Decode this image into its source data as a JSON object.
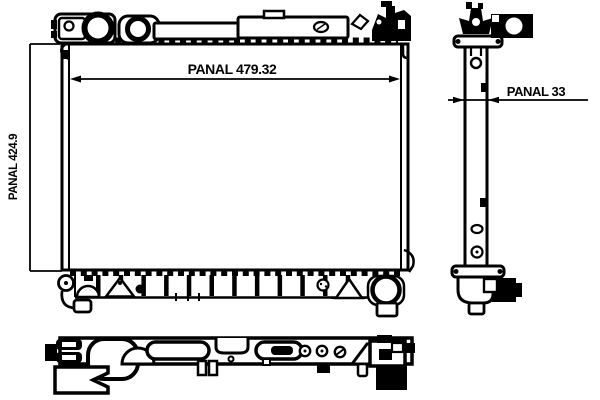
{
  "drawing": {
    "type": "radiator-technical-drawing",
    "dimensions": {
      "width": {
        "label": "PANAL 479.32",
        "value": 479.32
      },
      "height": {
        "label": "PANAL 424.9",
        "value": 424.9
      },
      "depth": {
        "label": "PANAL 33",
        "value": 33
      }
    },
    "colors": {
      "ink": "#000000",
      "background": "#ffffff"
    }
  }
}
